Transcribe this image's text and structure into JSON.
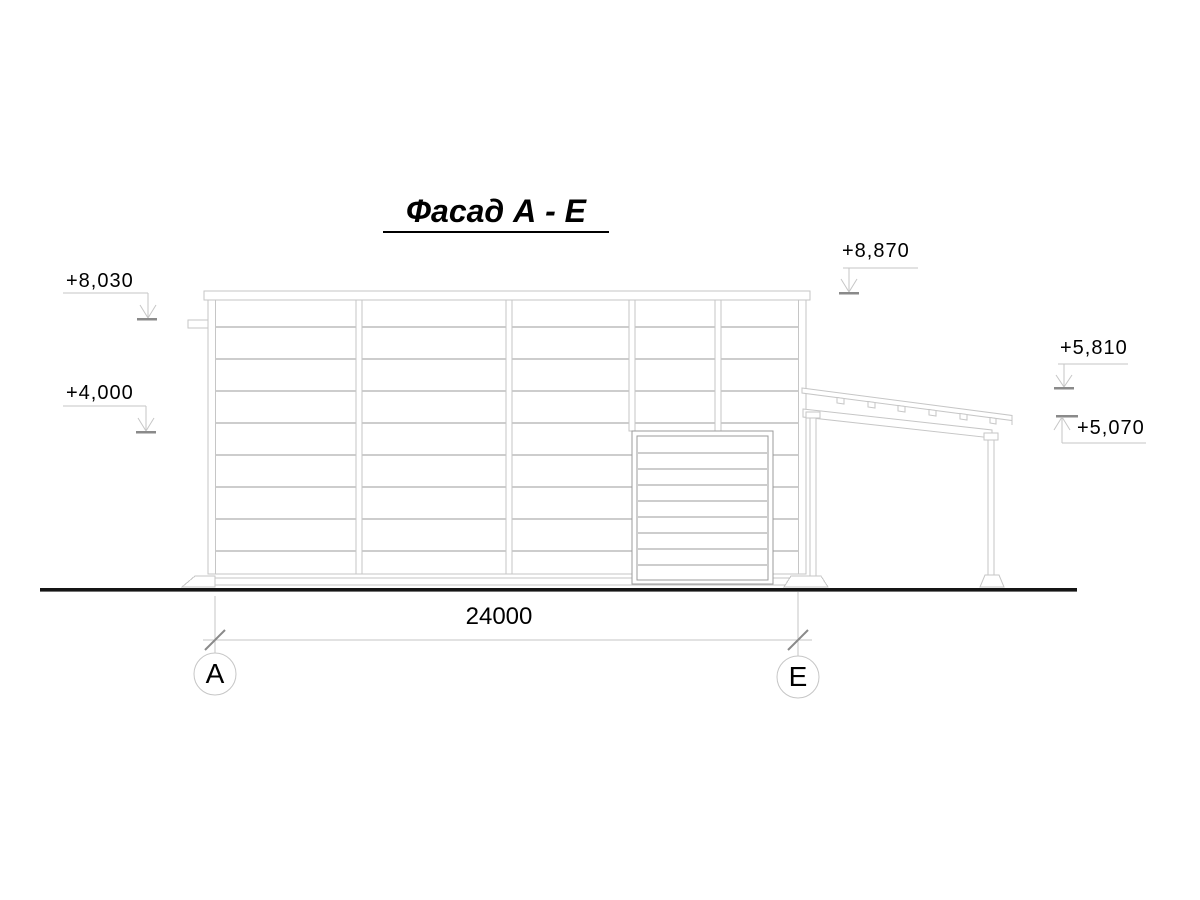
{
  "drawing": {
    "title": "Фасад А - Е",
    "levels": {
      "parapet_left": "+8,030",
      "door_head_left": "+4,000",
      "parapet_right": "+8,870",
      "canopy_high": "+5,810",
      "canopy_low": "+5,070"
    },
    "dimension": {
      "span": "24000"
    },
    "axes": {
      "start": "А",
      "end": "Е"
    },
    "colors": {
      "line_light": "#c6c6c6",
      "line_medium": "#9b9b9b",
      "line_dark": "#8a8a8a",
      "ground": "#151515",
      "text": "#000000"
    }
  }
}
